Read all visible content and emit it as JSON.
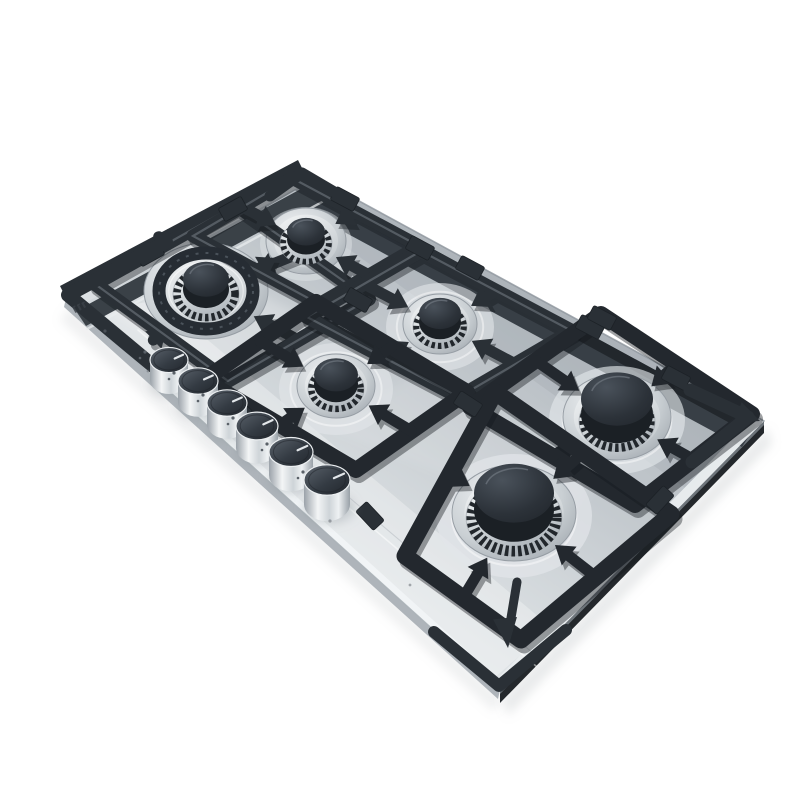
{
  "meta": {
    "description": "Product photo: stainless steel 6-burner built-in gas cooktop (hob) with black cast-iron pan-support grates and six round stainless control knobs, shown tilted at an angle on a plain white background",
    "background": "#ffffff"
  },
  "palette": {
    "grate": "#2a3036",
    "grate_front": "#23282e",
    "grate_shadow": "#14181d",
    "grate_split": "#7d858d",
    "steel_edge_line": "#aab1b7",
    "channel": "#383f46",
    "channel_shadow": "#22272c",
    "underside": "#24282c",
    "knob_dot": "#5a6168",
    "brand_ink": "#3a4046"
  },
  "panels": [
    {
      "name": "cast-shadow-front",
      "pts": [
        [
          70,
          306
        ],
        [
          502,
          698
        ],
        [
          494,
          712
        ],
        [
          60,
          320
        ]
      ],
      "fill": "#9aa0a5",
      "opacity": 0.16,
      "blur": true
    },
    {
      "name": "cast-shadow-right",
      "pts": [
        [
          502,
          698
        ],
        [
          768,
          428
        ],
        [
          772,
          444
        ],
        [
          508,
          716
        ]
      ],
      "fill": "#9aa0a5",
      "opacity": 0.22,
      "blur": true
    },
    {
      "name": "underside-right",
      "pts": [
        [
          500,
          690
        ],
        [
          764,
          421
        ],
        [
          764,
          433
        ],
        [
          500,
          703
        ]
      ],
      "fill": "#24282c",
      "opacity": 1
    },
    {
      "name": "underside-right-top-line",
      "pts": [
        [
          500,
          690
        ],
        [
          764,
          421
        ],
        [
          764,
          425
        ],
        [
          500,
          694
        ]
      ],
      "fill": "#6d747a",
      "opacity": 1
    },
    {
      "name": "underside-front",
      "pts": [
        [
          66,
          298
        ],
        [
          500,
          690
        ],
        [
          498,
          699
        ],
        [
          64,
          307
        ]
      ],
      "fill": "#aeb4ba",
      "opacity": 1
    },
    {
      "name": "surface",
      "pts": [
        [
          66,
          298
        ],
        [
          302,
          170
        ],
        [
          764,
          421
        ],
        [
          500,
          690
        ]
      ],
      "fill": "@gSteel",
      "opacity": 1
    },
    {
      "name": "back-half-shade",
      "pts": [
        [
          302,
          170
        ],
        [
          764,
          421
        ],
        [
          688,
          490
        ],
        [
          330,
          236
        ]
      ],
      "fill": "#7c858d",
      "opacity": 0.14
    },
    {
      "name": "front-margin-highlight",
      "pts": [
        [
          84,
          312
        ],
        [
          494,
          678
        ],
        [
          552,
          628
        ],
        [
          160,
          300
        ]
      ],
      "fill": "#ffffff",
      "opacity": 0.3
    },
    {
      "name": "wok-glow",
      "pts": [
        [
          100,
          305
        ],
        [
          200,
          370
        ],
        [
          340,
          335
        ],
        [
          210,
          268
        ]
      ],
      "fill": "#ffffff",
      "opacity": 0.22,
      "blur": true
    },
    {
      "name": "mid-sheen",
      "pts": [
        [
          330,
          430
        ],
        [
          560,
          520
        ],
        [
          640,
          450
        ],
        [
          420,
          370
        ]
      ],
      "fill": "#ffffff",
      "opacity": 0.1,
      "blur": true
    },
    {
      "name": "back-channel",
      "pts": [
        [
          312,
          183
        ],
        [
          756,
          425
        ],
        [
          742,
          447
        ],
        [
          298,
          207
        ]
      ],
      "fill": "#383f46",
      "opacity": 1
    },
    {
      "name": "back-channel-shadow",
      "pts": [
        [
          312,
          183
        ],
        [
          756,
          425
        ],
        [
          750,
          434
        ],
        [
          306,
          192
        ]
      ],
      "fill": "#22272c",
      "opacity": 1
    },
    {
      "name": "left-bevel",
      "pts": [
        [
          66,
          298
        ],
        [
          302,
          170
        ],
        [
          310,
          181
        ],
        [
          74,
          309
        ]
      ],
      "fill": "@gBevel",
      "opacity": 1
    },
    {
      "name": "left-channel",
      "pts": [
        [
          76,
          311
        ],
        [
          310,
          184
        ],
        [
          320,
          199
        ],
        [
          86,
          326
        ]
      ],
      "fill": "#3a4147",
      "opacity": 1
    },
    {
      "name": "left-edge-rail",
      "pts": [
        [
          60,
          286
        ],
        [
          298,
          160
        ],
        [
          306,
          176
        ],
        [
          68,
          302
        ]
      ],
      "fill": "#2a3036",
      "opacity": 1
    },
    {
      "name": "front-bevel",
      "pts": [
        [
          66,
          298
        ],
        [
          500,
          690
        ],
        [
          505,
          685
        ],
        [
          71,
          293
        ]
      ],
      "fill": "#f1f4f6",
      "opacity": 1
    },
    {
      "name": "right-bevel",
      "pts": [
        [
          500,
          690
        ],
        [
          764,
          421
        ],
        [
          757,
          414
        ],
        [
          493,
          683
        ]
      ],
      "fill": "#e9edef",
      "opacity": 0.95
    }
  ],
  "lines": [
    {
      "name": "left-channel-ridge",
      "p": [
        87,
        329,
        322,
        202
      ],
      "stroke": "#e8ecee",
      "w": 2.4,
      "opacity": 0.75
    },
    {
      "name": "knobfield-crease-light",
      "p": [
        138,
        330,
        536,
        666
      ],
      "stroke": "#ffffff",
      "w": 1.6,
      "opacity": 0.5
    },
    {
      "name": "knobfield-crease-dark",
      "p": [
        143,
        323,
        540,
        659
      ],
      "stroke": "#9aa1a8",
      "w": 1.0,
      "opacity": 0.35
    },
    {
      "name": "front-edge-line",
      "p": [
        66,
        298,
        500,
        690
      ],
      "stroke": "#aab1b7",
      "w": 1.4,
      "opacity": 0.9
    },
    {
      "name": "back-edge-line",
      "p": [
        302,
        170,
        764,
        421
      ],
      "stroke": "#8d959c",
      "w": 1.6,
      "opacity": 0.8
    }
  ],
  "burners": [
    {
      "id": "wok-burner",
      "cx": 206,
      "cy": 291,
      "base_rx": 62,
      "base_ry": 48,
      "ring_rx": 47,
      "ring_ry": 38,
      "chrome_rx": 33,
      "chrome_ry": 27,
      "cap_rx": 23,
      "cap_ry": 19,
      "tip_r": 54,
      "fw": 14,
      "split": true,
      "double_ring": true,
      "frame": [
        [
          369,
          299
        ],
        [
          228,
          381
        ],
        [
          95,
          284
        ],
        [
          236,
          205
        ]
      ]
    },
    {
      "id": "aux-burner",
      "cx": 306,
      "cy": 241,
      "base_rx": 40,
      "base_ry": 33,
      "chrome_rx": 26,
      "chrome_ry": 21,
      "cap_rx": 19,
      "cap_ry": 15,
      "tip_r": 34,
      "fw": 13,
      "split": true,
      "pad_rx": 46,
      "pad_ry": 37,
      "pad_op": 0.45,
      "frame": [
        [
          419,
          246
        ],
        [
          319,
          304
        ],
        [
          193,
          236
        ],
        [
          292,
          178
        ]
      ]
    },
    {
      "id": "semi-rapid-burner-rear",
      "cx": 440,
      "cy": 324,
      "base_rx": 37,
      "base_ry": 30,
      "chrome_rx": 27,
      "chrome_ry": 22,
      "cap_rx": 21,
      "cap_ry": 17,
      "tip_r": 36,
      "fw": 14,
      "split": true,
      "pad_rx": 54,
      "pad_ry": 44,
      "pad_op": 0.6,
      "frame": [
        [
          572,
          331
        ],
        [
          459,
          397
        ],
        [
          307,
          317
        ],
        [
          421,
          251
        ]
      ]
    },
    {
      "id": "semi-rapid-burner-front",
      "cx": 336,
      "cy": 386,
      "base_rx": 39,
      "base_ry": 32,
      "chrome_rx": 28,
      "chrome_ry": 23,
      "cap_rx": 22,
      "cap_ry": 18,
      "tip_r": 38,
      "fw": 16,
      "pad_rx": 57,
      "pad_ry": 46,
      "pad_op": 0.6,
      "frame": [
        [
          467,
          392
        ],
        [
          356,
          470
        ],
        [
          204,
          380
        ],
        [
          316,
          302
        ]
      ]
    },
    {
      "id": "rapid-burner-right",
      "cx": 617,
      "cy": 417,
      "base_rx": 54,
      "base_ry": 43,
      "chrome_rx": 38,
      "chrome_ry": 30,
      "cap_rx": 36,
      "cap_ry": 29,
      "tip_r": 46,
      "fw": 16,
      "pad_rx": 68,
      "pad_ry": 54,
      "pad_op": 0.65,
      "frame": [
        [
          752,
          414
        ],
        [
          635,
          505
        ],
        [
          470,
          407
        ],
        [
          601,
          314
        ]
      ]
    },
    {
      "id": "rapid-burner-bottom",
      "cx": 514,
      "cy": 513,
      "base_rx": 62,
      "base_ry": 48,
      "chrome_rx": 48,
      "chrome_ry": 38,
      "cap_rx": 40,
      "cap_ry": 32,
      "tip_r": 52,
      "fw": 17,
      "pad_rx": 78,
      "pad_ry": 62,
      "pad_op": 0.7,
      "frame": [
        [
          671,
          514
        ],
        [
          521,
          640
        ],
        [
          405,
          556
        ],
        [
          495,
          392
        ]
      ]
    }
  ],
  "grate": {
    "tabs": [
      [
        345,
        199,
        28
      ],
      [
        470,
        268,
        28
      ],
      [
        590,
        327,
        28
      ],
      [
        676,
        378,
        28
      ],
      [
        150,
        254,
        -29
      ],
      [
        233,
        209,
        -29
      ],
      [
        238,
        408,
        42
      ],
      [
        370,
        516,
        47
      ],
      [
        660,
        500,
        -47
      ],
      [
        420,
        248,
        28
      ],
      [
        358,
        300,
        30
      ],
      [
        468,
        404,
        33
      ],
      [
        602,
        318,
        28
      ]
    ],
    "tab_w": 26,
    "tab_h": 15,
    "corners": [
      {
        "pts": [
          [
            166,
            242
          ],
          [
            68,
            295
          ],
          [
            158,
            370
          ]
        ],
        "w": 14
      },
      {
        "pts": [
          [
            270,
            196
          ],
          [
            302,
            173
          ],
          [
            336,
            193
          ]
        ],
        "w": 11
      },
      {
        "pts": [
          [
            690,
            390
          ],
          [
            748,
            417
          ],
          [
            692,
            462
          ]
        ],
        "w": 13
      },
      {
        "pts": [
          [
            434,
            632
          ],
          [
            499,
            686
          ],
          [
            566,
            630
          ]
        ],
        "w": 12
      }
    ],
    "spears": [
      {
        "tip": [
          760,
          421
        ],
        "dir": [
          0.93,
          0.36
        ],
        "len": 24,
        "hw": 11
      },
      {
        "tip": [
          508,
          648
        ],
        "dir": [
          0.1,
          0.995
        ],
        "len": 30,
        "hw": 12,
        "bar": [
          517,
          582,
          511,
          618
        ]
      }
    ]
  },
  "knobs": {
    "items": [
      [
        169,
        360,
        19
      ],
      [
        198,
        381,
        20
      ],
      [
        227,
        403,
        20
      ],
      [
        257,
        426,
        21
      ],
      [
        291,
        452,
        22
      ],
      [
        327,
        480,
        23
      ]
    ],
    "marker_color": "#e3e7ea"
  },
  "brand_mark": {
    "x": 72,
    "y": 307,
    "angle": -30,
    "glyphs": 3,
    "legible": false
  },
  "surface_dots": [
    [
      105,
      331,
      1.6
    ],
    [
      330,
      521,
      1.6
    ],
    [
      148,
      371,
      1.4
    ],
    [
      410,
      585,
      1.4
    ]
  ]
}
